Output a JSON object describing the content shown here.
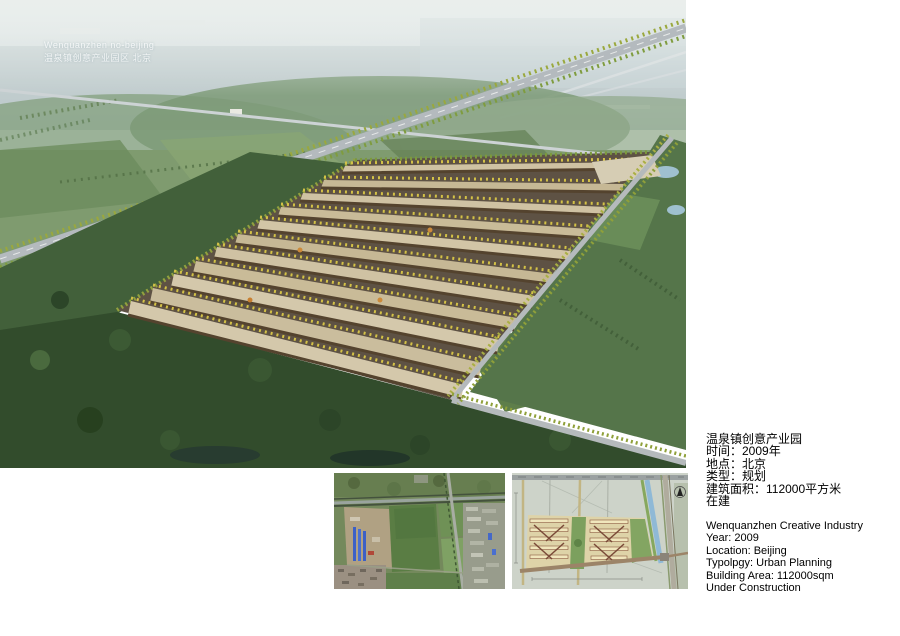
{
  "watermark": {
    "line1": "Wenquanzhen no-beijing",
    "line2": "温泉镇创意产业园区 北京"
  },
  "info_cn": {
    "lines": [
      "温泉镇创意产业园",
      "时间：2009年",
      "地点：北京",
      "类型：规划",
      "建筑面积：112000平方米",
      "在建"
    ]
  },
  "info_en": {
    "lines": [
      "Wenquanzhen Creative Industry",
      "Year: 2009",
      "Location: Beijing",
      "Typolpgy: Urban Planning",
      "Building Area: 112000sqm",
      "Under Construction"
    ]
  },
  "images": {
    "main": "aerial perspective rendering of creative industry park with highway interchange",
    "satellite": "satellite photo of existing site with farm fields and highway",
    "siteplan": "master plan drawing of the park with canal and north arrow"
  },
  "palette": {
    "sky_haze": "#c9d4d6",
    "hill_green": "#7d9a77",
    "field_green": "#7f9b6f",
    "forest_dark": "#324c2c",
    "road_grey": "#b5babc",
    "roof_tan": "#cfc2a3",
    "facade_brown": "#54432e",
    "tree_yellow": "#d4c247",
    "water_blue": "#9fc0cf",
    "plan_bg": "#cdd3c9",
    "plan_building": "#f0e6bc",
    "plan_canal": "#8fb9d6",
    "sat_field": "#5a7d44",
    "sat_dirt": "#b0a183",
    "text_black": "#000000"
  }
}
